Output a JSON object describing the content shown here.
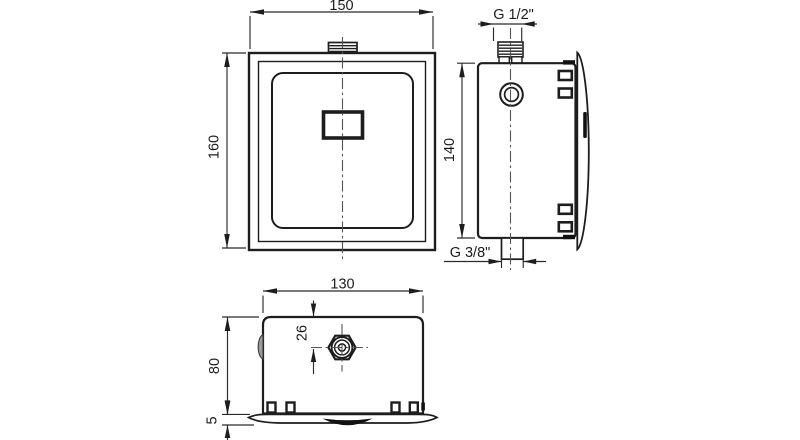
{
  "drawing_title": "flush-valve-three-view-technical-drawing",
  "colors": {
    "line": "#1d1d1d",
    "background": "#ffffff",
    "dim_line": "#2b2b2b"
  },
  "labels": {
    "front": {
      "width": "150",
      "height": "160"
    },
    "side": {
      "inlet_thread": "G 1/2\"",
      "height": "140",
      "outlet_thread": "G 3/8\""
    },
    "bottom": {
      "width": "130",
      "nut_offset": "26",
      "depth": "80",
      "plate_thickness": "5"
    }
  }
}
